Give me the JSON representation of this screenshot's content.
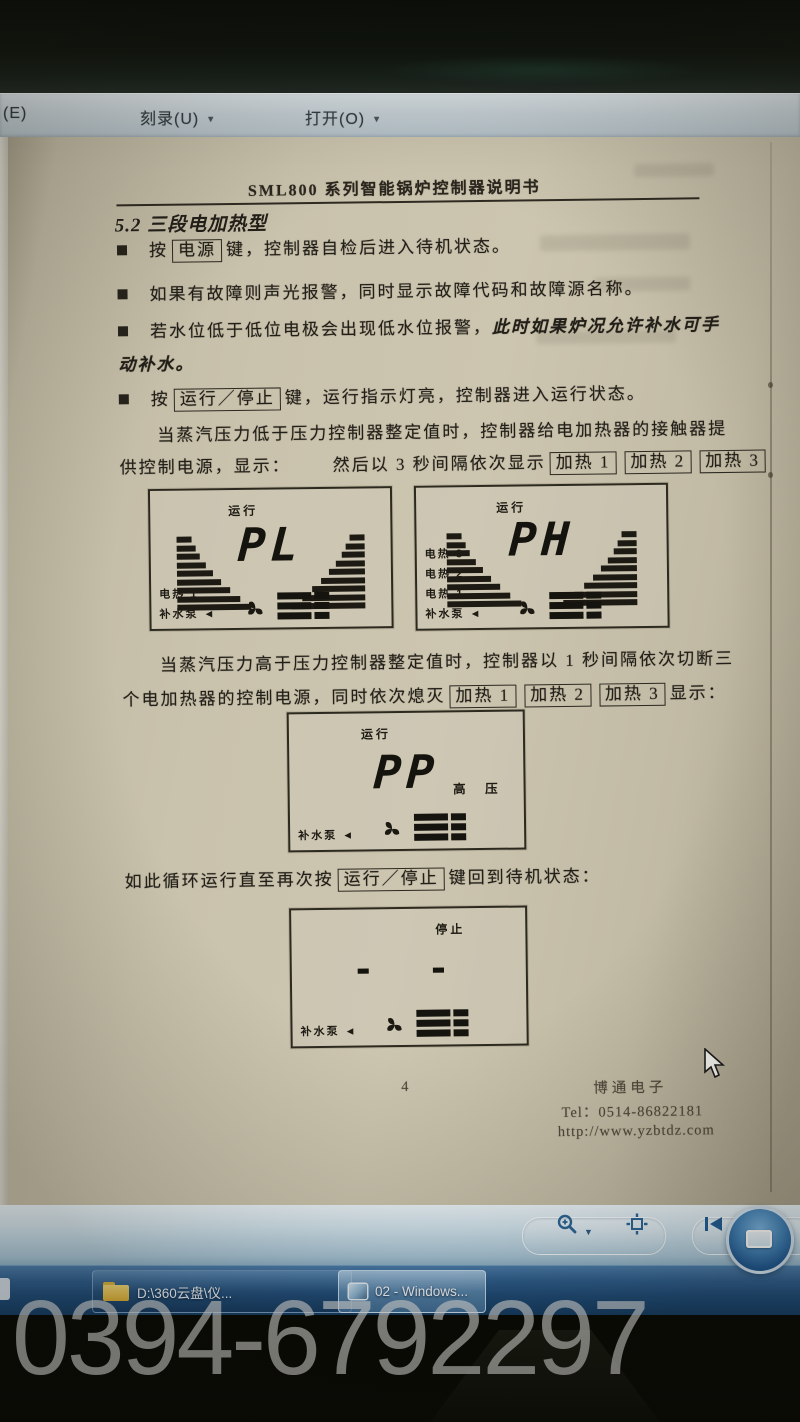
{
  "menu_bar": {
    "partial_item": "(E)",
    "burn_item": "刻录(U)",
    "open_item": "打开(O)"
  },
  "document": {
    "header_title": "SML800 系列智能锅炉控制器说明书",
    "section_heading": "5.2 三段电加热型",
    "bullet1": {
      "pre": "按",
      "key": "电源",
      "post": "键，控制器自检后进入待机状态。"
    },
    "bullet2": "如果有故障则声光报警，同时显示故障代码和故障源名称。",
    "bullet3_normal": "若水位低于低位电极会出现低水位报警，",
    "bullet3_italic": "此时如果炉况允许补水可手",
    "bullet3_line2": "动补水。",
    "bullet4": {
      "pre": "按",
      "key": "运行／停止",
      "post": "键，运行指示灯亮，控制器进入运行状态。"
    },
    "para_low_line1": "当蒸汽压力低于压力控制器整定值时，控制器给电加热器的接触器提",
    "para_low_line2a": "供控制电源，显示：",
    "para_low_line2b": "然后以 3 秒间隔依次显示",
    "heat_keys": [
      "加热 1",
      "加热 2",
      "加热 3"
    ],
    "para_high_line1": "当蒸汽压力高于压力控制器整定值时，控制器以 1 秒间隔依次切断三",
    "para_high_line2a": "个电加热器的控制电源，同时依次熄灭",
    "para_high_line2b": "显示：",
    "loop_line": {
      "pre": "如此循环运行直至再次按",
      "key": "运行／停止",
      "post": "键回到待机状态："
    },
    "figures": [
      {
        "status": "运行",
        "value": "PL",
        "labels": [
          "电热 1",
          "补水泵 ◄"
        ]
      },
      {
        "status": "运行",
        "value": "PH",
        "labels": [
          "电热 3",
          "电热 2",
          "电热 1",
          "补水泵 ◄"
        ]
      },
      {
        "status": "运行",
        "value": "PP",
        "right_label": "高 压",
        "labels": [
          "补水泵 ◄"
        ]
      },
      {
        "status": "停止",
        "value": "- -",
        "labels": [
          "补水泵 ◄"
        ]
      }
    ],
    "footer": {
      "page_number": "4",
      "company": "博通电子",
      "tel": "Tel：0514-86822181",
      "url": "http://www.yzbtdz.com"
    }
  },
  "taskbar": {
    "button1_label": "D:\\360云盘\\仪...",
    "button2_label": "02 - Windows..."
  },
  "watermark_text": "0394-6792297",
  "colors": {
    "taskbar_blue": "#1c4a77",
    "toolbar_blue": "#a9c6d8",
    "page_beige": "#ccc5af",
    "accent_icon_blue": "#2a6496"
  }
}
